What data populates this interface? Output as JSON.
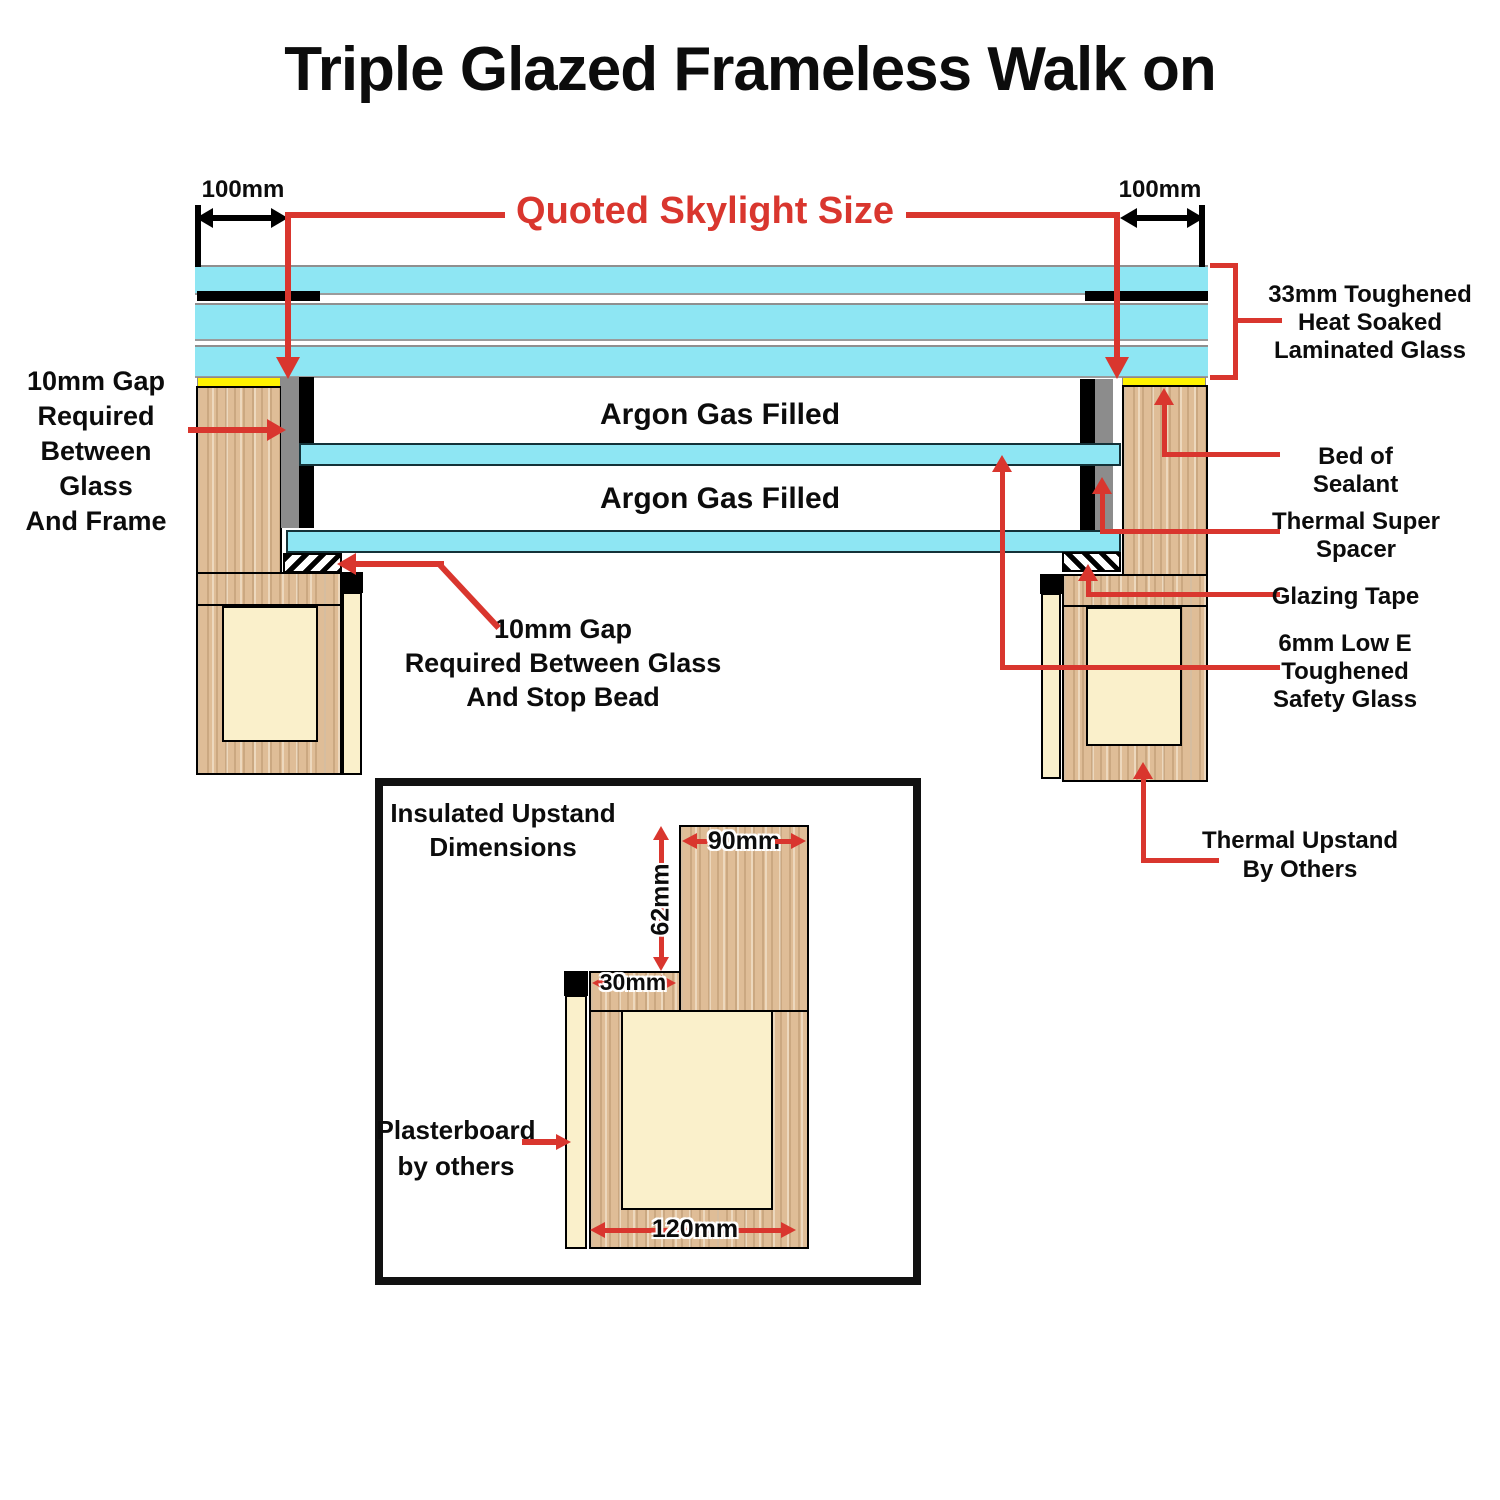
{
  "title": "Triple Glazed Frameless Walk on",
  "colors": {
    "glass_cyan": "#8ee6f3",
    "wood_tan": "#dfbd97",
    "insulation_cream": "#faf0cb",
    "sealant_yellow": "#fff200",
    "annotation_red": "#d9362e",
    "spacer_gray": "#8c8c8c",
    "line_black": "#000000"
  },
  "main": {
    "dim_left": "100mm",
    "dim_right": "100mm",
    "quoted_size": "Quoted Skylight Size",
    "argon_top": "Argon Gas Filled",
    "argon_bottom": "Argon Gas Filled",
    "gap_frame": {
      "l1": "10mm Gap",
      "l2": "Required",
      "l3": "Between Glass",
      "l4": "And Frame"
    },
    "gap_stopbead": {
      "l1": "10mm Gap",
      "l2": "Required Between Glass",
      "l3": "And Stop Bead"
    },
    "laminated": {
      "l1": "33mm Toughened",
      "l2": "Heat Soaked",
      "l3": "Laminated Glass"
    },
    "bed_sealant": "Bed of Sealant",
    "super_spacer": {
      "l1": "Thermal Super",
      "l2": "Spacer"
    },
    "glazing_tape": "Glazing Tape",
    "low_e": {
      "l1": "6mm Low E",
      "l2": "Toughened",
      "l3": "Safety Glass"
    },
    "thermal_upstand": {
      "l1": "Thermal Upstand",
      "l2": "By Others"
    }
  },
  "inset": {
    "title": {
      "l1": "Insulated Upstand",
      "l2": "Dimensions"
    },
    "dim_90": "90mm",
    "dim_62": "62mm",
    "dim_30": "30mm",
    "dim_120": "120mm",
    "plasterboard": {
      "l1": "Plasterboard",
      "l2": "by others"
    }
  }
}
